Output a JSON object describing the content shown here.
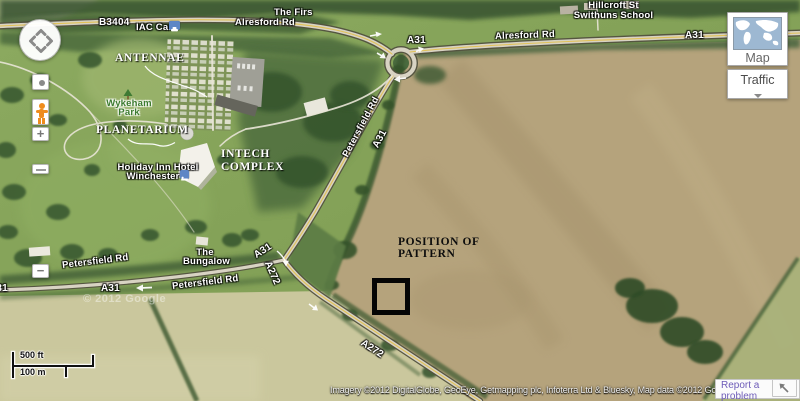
{
  "map_labels": {
    "b3404": "B3404",
    "iac_cars": "IAC Cars",
    "the_firs": "The Firs",
    "alresford_rd_left": "Alresford Rd",
    "alresford_rd_right": "Alresford Rd",
    "a31_roundabout": "A31",
    "a31_top_right": "A31",
    "hillcroft_line1": "Hillcroft St",
    "hillcroft_line2": "Swithuns School",
    "wykeham_line1": "Wykeham",
    "wykeham_line2": "Park",
    "holiday_inn_line1": "Holiday Inn Hotel",
    "holiday_inn_line2": "Winchester",
    "bungalow_line1": "The",
    "bungalow_line2": "Bungalow",
    "petersfield_rd_upper_left": "Petersfield Rd",
    "petersfield_rd_mid": "Petersfield Rd",
    "petersfield_rd_diagonal": "Petersfield Rd",
    "a31_left_clipped": "A31",
    "a31_mid": "A31",
    "a31_diagonal": "A31",
    "a31_junction": "A31",
    "a272_upper": "A272",
    "a272_lower": "A272"
  },
  "annotations": {
    "antennae": "ANTENNAE",
    "planetarium": "PLANETARIUM",
    "intech_line1": "INTECH",
    "intech_line2": "COMPLEX",
    "position_line1": "POSITION OF",
    "position_line2": "PATTERN"
  },
  "controls": {
    "map_button": "Map",
    "traffic_button": "Traffic",
    "zoom_in": "+",
    "zoom_out": "−"
  },
  "scale": {
    "feet": "500 ft",
    "meters": "100 m"
  },
  "watermark": "© 2012 Google",
  "attribution": {
    "text": "Imagery ©2012 DigitalGlobe, GeoEye, Getmapping plc, Infoterra Ltd & Bluesky, Map data ©2012 Google -",
    "report_link": "Report a problem"
  },
  "colors": {
    "poi_icon_blue": "#5d86c5",
    "pegman_orange": "#ef8c1d",
    "annotation_white": "#ffffff",
    "annotation_black": "#0d0d0d",
    "link_purple": "#6e5cb8",
    "field_tan": "#b5a37c",
    "field_green": "#86a35a"
  }
}
